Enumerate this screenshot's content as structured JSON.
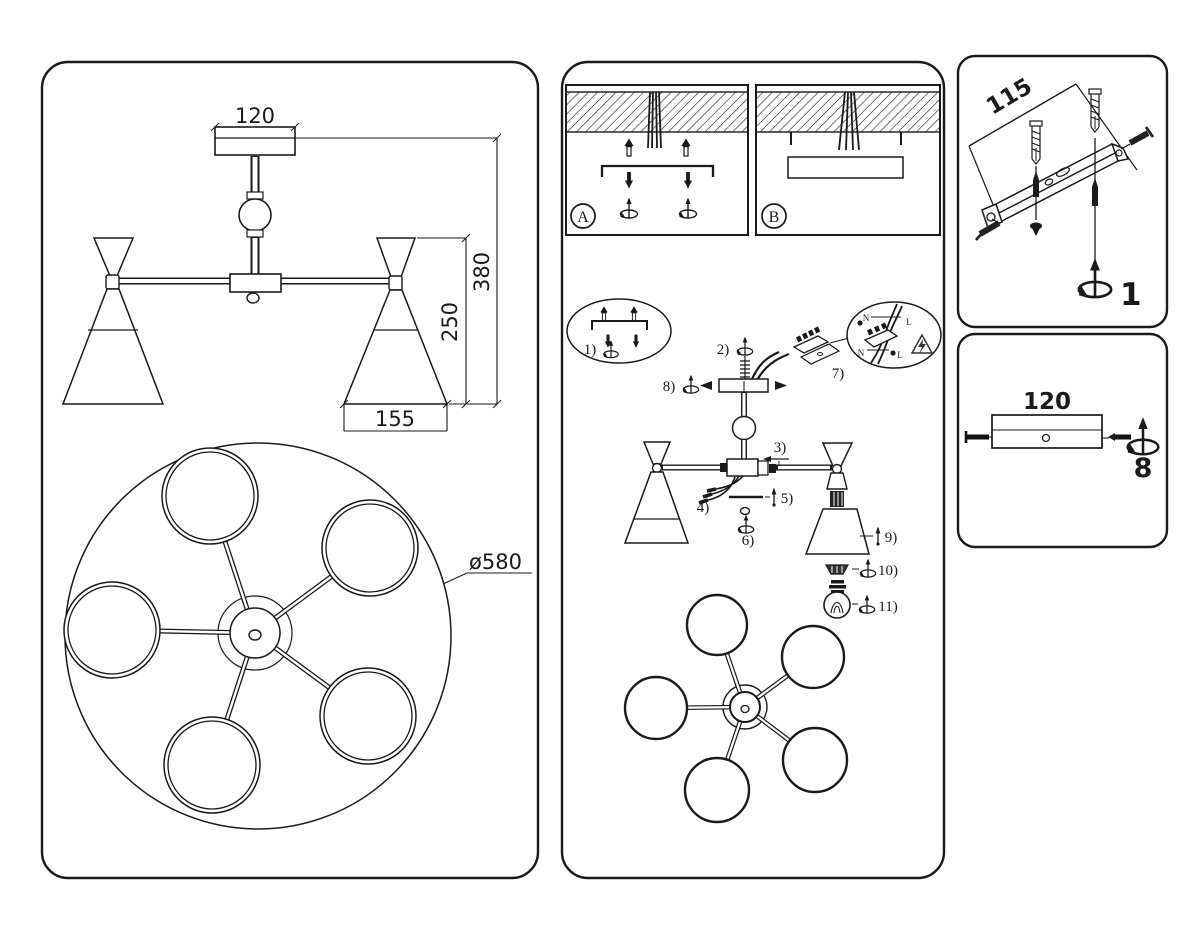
{
  "left_panel": {
    "dim_width": "120",
    "dim_height": "380",
    "dim_shade_height": "250",
    "dim_shade_width": "155",
    "dim_diameter": "ø580"
  },
  "middle_panel": {
    "label_a": "A",
    "label_b": "B",
    "steps": {
      "s1": "1)",
      "s2": "2)",
      "s3": "3)",
      "s4": "4)",
      "s5": "5)",
      "s6": "6)",
      "s7": "7)",
      "s8": "8)",
      "s9": "9)",
      "s10": "10)",
      "s11": "11)"
    },
    "terminal": {
      "n_top": "N",
      "l_top": "L",
      "n_bottom": "N",
      "l_bottom": "L"
    }
  },
  "bracket_panel": {
    "dim_length": "115",
    "step": "1"
  },
  "canopy_panel": {
    "dim_width": "120",
    "step": "8"
  }
}
